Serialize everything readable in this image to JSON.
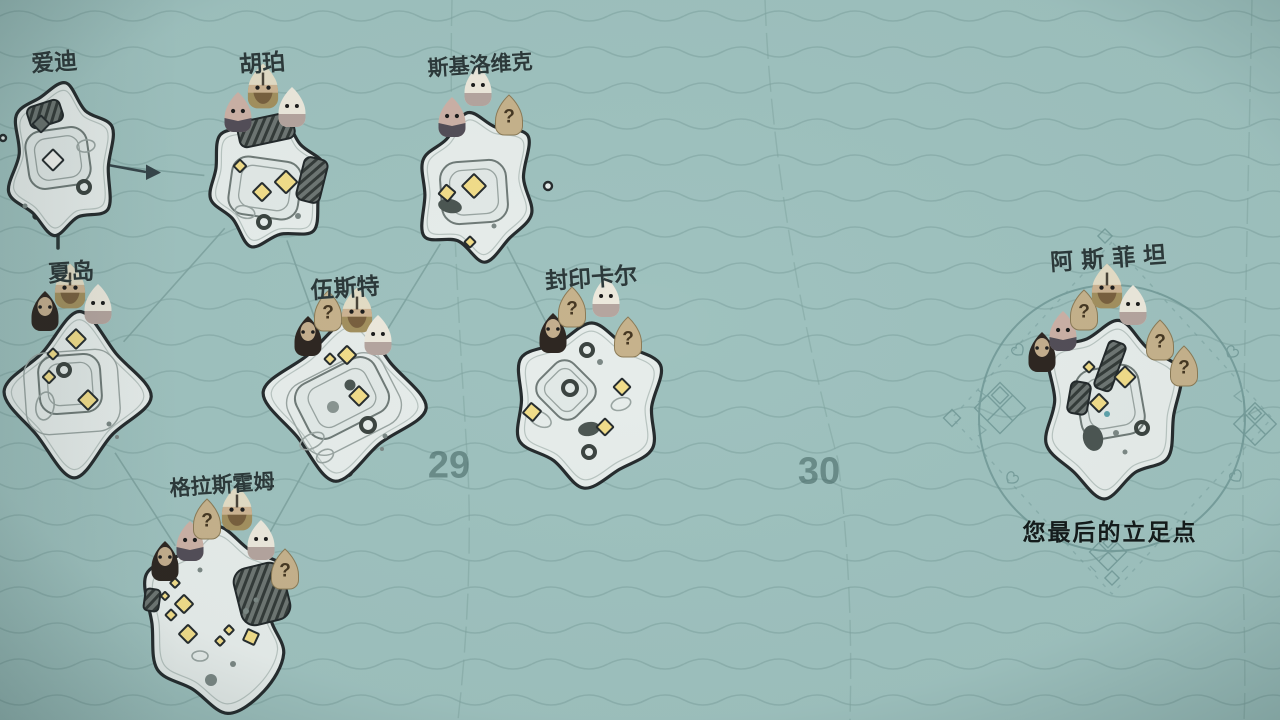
{
  "app": {
    "kind": "island-strategy campaign world map",
    "background": "sea with wave pattern"
  },
  "colors": {
    "water": "#9fc2bf",
    "wave_line": "#84a8a5",
    "ink": "#2c393a",
    "island_fill": "#e7edeb",
    "island_outline": "#262c2e",
    "building_yellow": "#f2dd8a",
    "ruin_gray": "#6e7673",
    "token_tan": "#c6b28c",
    "route_line": "#7fa3a0"
  },
  "map": {
    "sector_numbers": [
      {
        "label": "29"
      },
      {
        "label": "30"
      }
    ],
    "travel_arrow": {
      "from": "爱迪",
      "to": "胡珀"
    },
    "islands": [
      {
        "id": "aidi",
        "name": "爱迪",
        "units": [],
        "buildings_state": "destroyed"
      },
      {
        "id": "hupo",
        "name": "胡珀",
        "units": [
          "masked",
          "helmet",
          "white"
        ]
      },
      {
        "id": "sijiluoweike",
        "name": "斯基洛维克",
        "units": [
          "masked",
          "white",
          "question"
        ]
      },
      {
        "id": "xiadao",
        "name": "夏岛",
        "units": [
          "dark",
          "helmet",
          "white"
        ]
      },
      {
        "id": "wusite",
        "name": "伍斯特",
        "units": [
          "dark",
          "question",
          "helmet",
          "white"
        ]
      },
      {
        "id": "fengyinkaer",
        "name": "封印卡尔",
        "units": [
          "dark",
          "question",
          "white",
          "question"
        ]
      },
      {
        "id": "gelasihuomu",
        "name": "格拉斯霍姆",
        "units": [
          "dark",
          "masked",
          "question",
          "helmet",
          "white",
          "question"
        ]
      },
      {
        "id": "asifeitan",
        "name": "阿斯菲坦",
        "units": [
          "dark",
          "masked",
          "question",
          "helmet",
          "white",
          "question",
          "question"
        ],
        "subtitle": "您最后的立足点",
        "highlighted": true
      }
    ],
    "routes": [
      [
        "aidi",
        "hupo"
      ],
      [
        "hupo",
        "xiadao"
      ],
      [
        "hupo",
        "wusite"
      ],
      [
        "sijiluoweike",
        "wusite"
      ],
      [
        "sijiluoweike",
        "fengyinkaer"
      ],
      [
        "xiadao",
        "gelasihuomu"
      ],
      [
        "wusite",
        "gelasihuomu"
      ]
    ],
    "unit_types_legend": {
      "helmet": "viking-helmet-commander",
      "white": "white-hooded-commander",
      "dark": "dark-hooded-commander",
      "masked": "masked-commander",
      "question": "unknown-question-token"
    }
  }
}
